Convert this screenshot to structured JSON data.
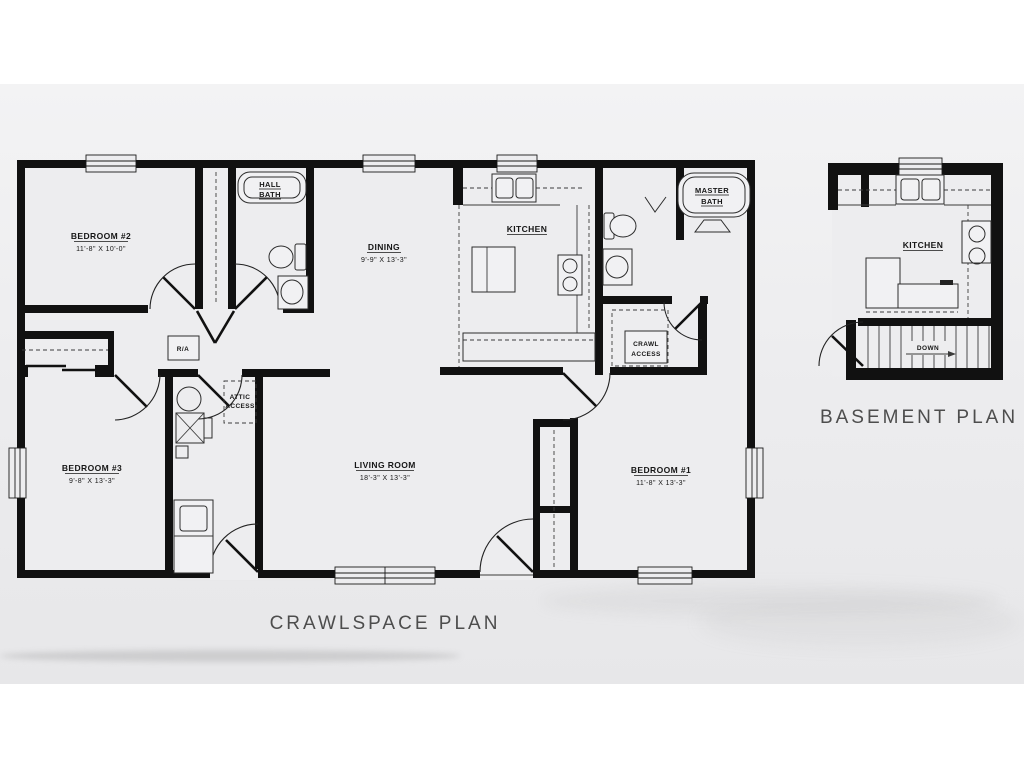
{
  "titles": {
    "crawlspace": "CRAWLSPACE PLAN",
    "basement": "BASEMENT PLAN"
  },
  "crawlspace": {
    "bedroom2": {
      "name": "BEDROOM #2",
      "dims": "11'-8\" X 10'-0\""
    },
    "bedroom3": {
      "name": "BEDROOM #3",
      "dims": "9'-8\" X 13'-3\""
    },
    "bedroom1": {
      "name": "BEDROOM #1",
      "dims": "11'-8\" X 13'-3\""
    },
    "dining": {
      "name": "DINING",
      "dims": "9'-9\" X 13'-3\""
    },
    "living": {
      "name": "LIVING ROOM",
      "dims": "18'-3\" X 13'-3\""
    },
    "kitchen": {
      "name": "KITCHEN"
    },
    "hall_bath": {
      "line1": "HALL",
      "line2": "BATH"
    },
    "master_bath": {
      "line1": "MASTER",
      "line2": "BATH"
    },
    "crawl_access": {
      "line1": "CRAWL",
      "line2": "ACCESS"
    },
    "attic_access": {
      "line1": "ATTIC",
      "line2": "ACCESS"
    },
    "return_air": "R/A"
  },
  "basement": {
    "kitchen": "KITCHEN",
    "down": "DOWN"
  },
  "colors": {
    "wall": "#111111",
    "floor": "#ededef",
    "background_band": "#ebebed",
    "title_text": "#4d4d4d",
    "label_text": "#161616"
  }
}
